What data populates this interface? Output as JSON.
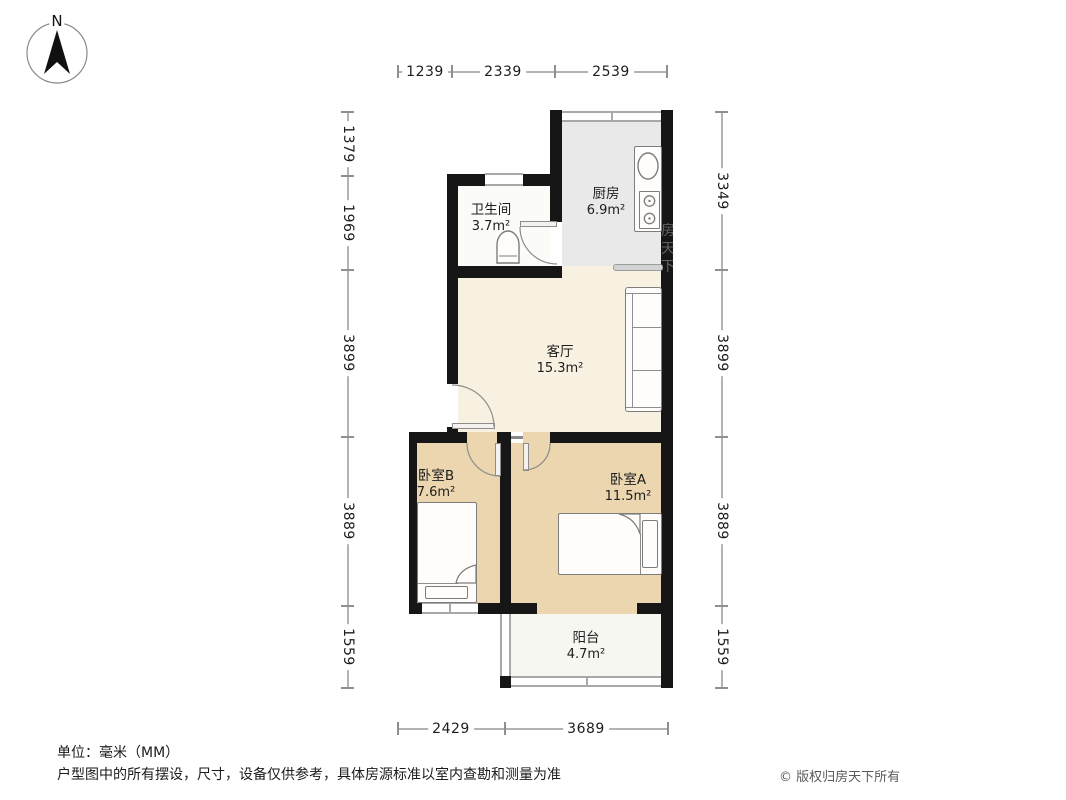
{
  "compass": {
    "label": "N"
  },
  "rooms": [
    {
      "id": "kitchen",
      "name": "厨房",
      "area": "6.9m²"
    },
    {
      "id": "bathroom",
      "name": "卫生间",
      "area": "3.7m²"
    },
    {
      "id": "living",
      "name": "客厅",
      "area": "15.3m²"
    },
    {
      "id": "bedroomB",
      "name": "卧室B",
      "area": "7.6m²"
    },
    {
      "id": "bedroomA",
      "name": "卧室A",
      "area": "11.5m²"
    },
    {
      "id": "balcony",
      "name": "阳台",
      "area": "4.7m²"
    }
  ],
  "dimensions": {
    "top": [
      "1239",
      "2339",
      "2539"
    ],
    "bottom": [
      "2429",
      "3689"
    ],
    "left": [
      "1379",
      "1969",
      "3899",
      "3889",
      "1559"
    ],
    "right": [
      "3349",
      "3899",
      "3889",
      "1559"
    ]
  },
  "footer": {
    "unit_note": "单位：毫米（MM）",
    "disclaimer": "户型图中的所有摆设，尺寸，设备仅供参考，具体房源标准以室内查勘和测量为准",
    "copyright": "© 版权归房天下所有"
  },
  "watermark": "房天下",
  "colors": {
    "wall": "#161616",
    "living_floor": "#f8f0e1",
    "bedroom_floor": "#ebd6af",
    "kitchen_floor": "#e9e9e9",
    "balcony_floor": "#f7f7f2",
    "bathroom_floor": "#fbfbf7",
    "dimension_line": "#b3b3b3"
  }
}
